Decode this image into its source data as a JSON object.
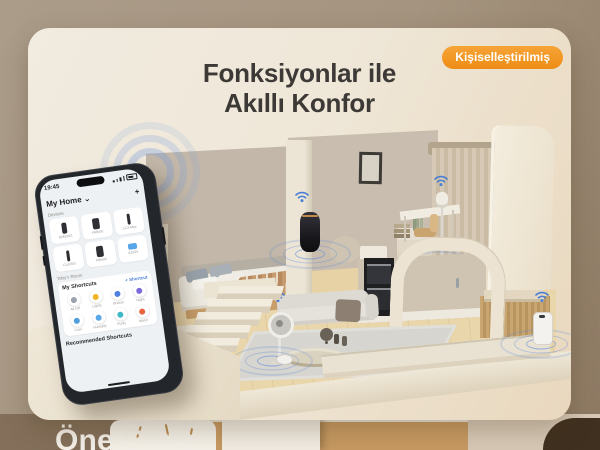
{
  "badge": {
    "label": "Kişiselleştirilmiş",
    "color": "#f2951f"
  },
  "title": {
    "line1": "Fonksiyonlar ile",
    "line2": "Akıllı Konfor",
    "color": "#3c3936"
  },
  "accent": {
    "wifi_blue": "#4a7fd4",
    "ripple_blue": "#7aa4e0"
  },
  "phone": {
    "status_time": "19:45",
    "home_label": "My Home",
    "home_chevron": "⌄",
    "add_icon": "+",
    "devices_section_label": "Devices",
    "device_tiles": [
      {
        "name": "HM500S"
      },
      {
        "name": "HM500"
      },
      {
        "name": "LC3 Max"
      },
      {
        "name": "CL605G"
      },
      {
        "name": "RB500"
      },
      {
        "name": "AJ500"
      }
    ],
    "room_label": "Toby's Room",
    "shortcuts_title": "My Shortcuts",
    "add_shortcut_label": "+ Shortcut",
    "shortcuts": [
      {
        "name": "All Off",
        "color": "#9aa3ad"
      },
      {
        "name": "Lights",
        "color": "#f0b429"
      },
      {
        "name": "Breeze",
        "color": "#4f7fe0"
      },
      {
        "name": "Night",
        "color": "#7b68d9"
      },
      {
        "name": "Cool",
        "color": "#4f9fe0"
      },
      {
        "name": "Humidify",
        "color": "#59a7e8"
      },
      {
        "name": "Purify",
        "color": "#3fb9c5"
      },
      {
        "name": "Warm",
        "color": "#e8643c"
      }
    ],
    "recommended_label": "Recommended Shortcuts"
  },
  "footer": {
    "heading": "Öne Çıkan"
  }
}
